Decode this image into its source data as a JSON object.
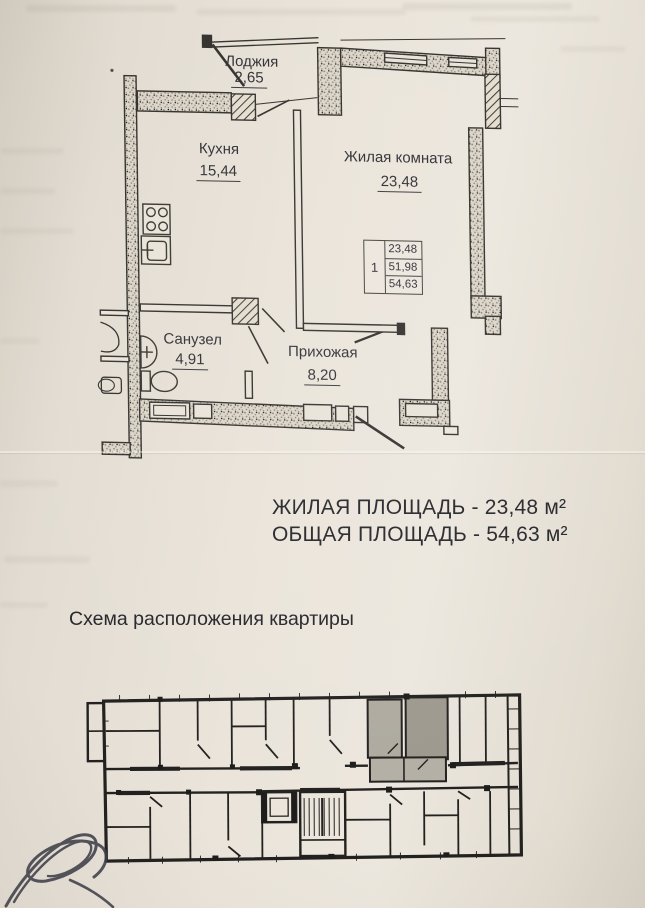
{
  "page": {
    "bg": "#eae4da",
    "ink": "#34322e",
    "highlight_gray": "#a9a59a"
  },
  "plan": {
    "rooms": {
      "loggia": {
        "name": "Лоджия",
        "area": "2,65"
      },
      "kitchen": {
        "name": "Кухня",
        "area": "15,44"
      },
      "living": {
        "name": "Жилая комната",
        "area": "23,48"
      },
      "bathroom": {
        "name": "Санузел",
        "area": "4,91"
      },
      "hallway": {
        "name": "Прихожая",
        "area": "8,20"
      }
    },
    "stamp": {
      "number": "1",
      "values": [
        "23,48",
        "51,98",
        "54,63"
      ]
    }
  },
  "summary": {
    "living_area_line": "ЖИЛАЯ ПЛОЩАДЬ - 23,48 м²",
    "total_area_line": "ОБЩАЯ ПЛОЩАДЬ - 54,63 м²"
  },
  "scheme": {
    "title": "Схема расположения квартиры"
  }
}
